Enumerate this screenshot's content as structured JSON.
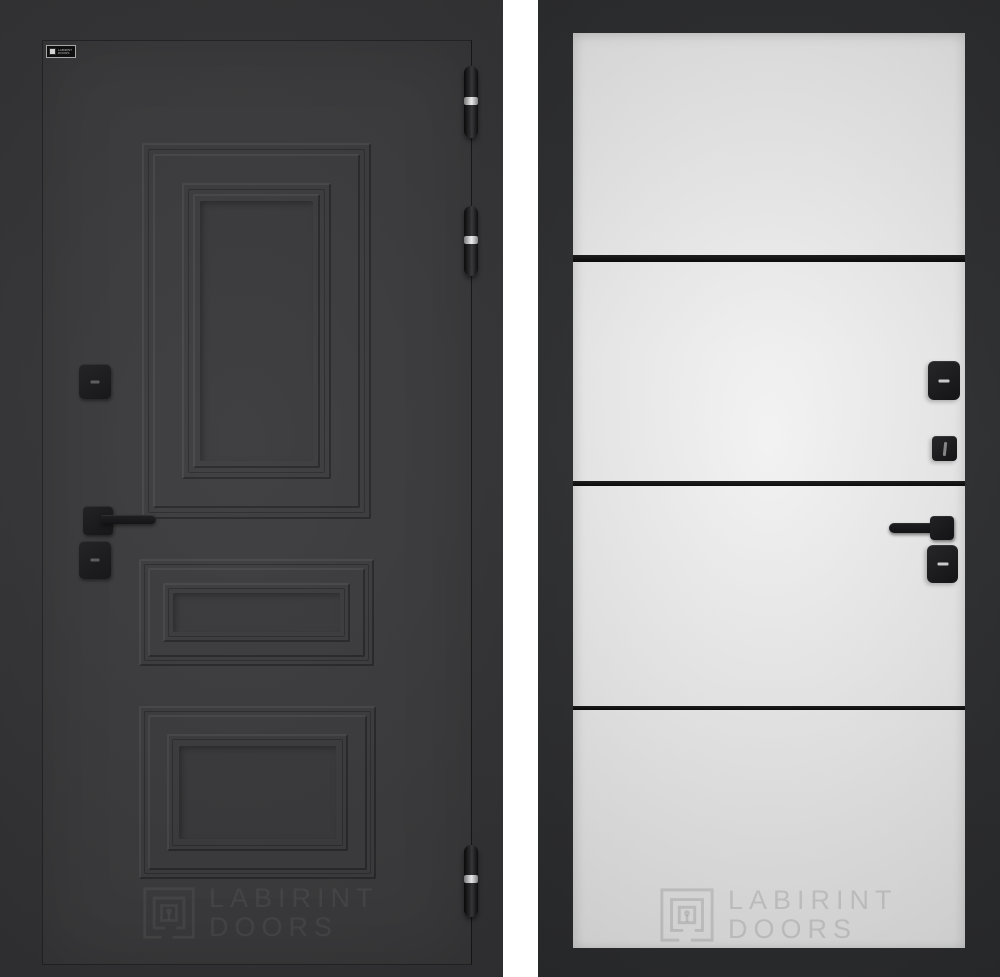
{
  "brand": "LABIRINT DOORS",
  "views": {
    "exterior": {
      "badge": {
        "line1": "LABIRINT",
        "line2": "DOORS"
      },
      "watermark": {
        "line1": "LABIRINT",
        "line2": "DOORS"
      },
      "colors": {
        "body": "#3b3b3d",
        "surround": "#333335",
        "molding_shadow": "#27272a",
        "molding_highlight": "#47474a",
        "hardware": "#17171a",
        "hinge_band": "#e8e8e8"
      },
      "panel_count": 3,
      "hinge_count": 3
    },
    "interior": {
      "watermark": {
        "line1": "LABIRINT",
        "line2": "DOORS"
      },
      "colors": {
        "frame": "#2d2e30",
        "panel": "#f0f0f0",
        "stripe": "#0b0b0c",
        "hardware": "#1b1b1e"
      },
      "stripe_count": 3
    }
  }
}
